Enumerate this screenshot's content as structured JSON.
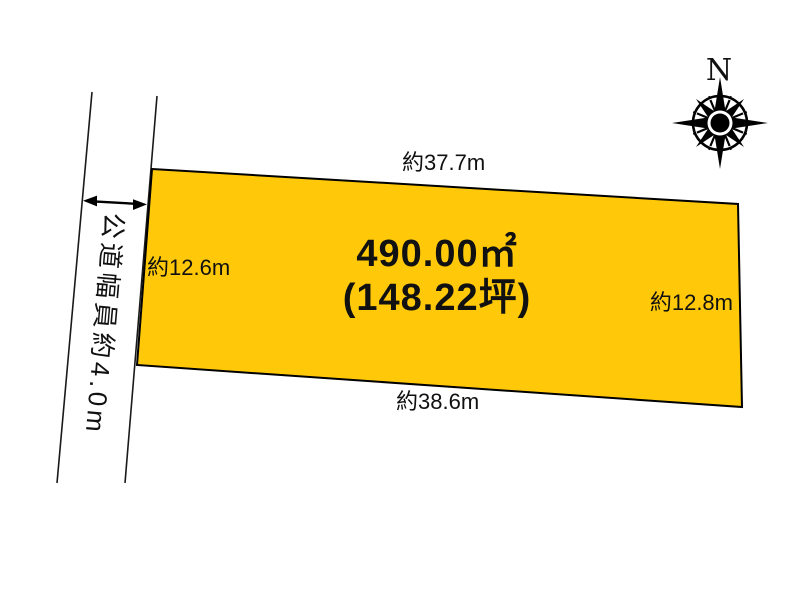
{
  "diagram": {
    "plot": {
      "area_sqm": "490.00㎡",
      "area_tsubo": "(148.22坪)",
      "fill_color": "#FFC90A",
      "top_length": "約37.7m",
      "bottom_length": "約38.6m",
      "left_length": "約12.6m",
      "right_length": "約12.8m"
    },
    "road": {
      "label": "公道幅員約4.0m",
      "width_note": "約4.0m"
    },
    "compass": {
      "north_label": "N"
    }
  }
}
